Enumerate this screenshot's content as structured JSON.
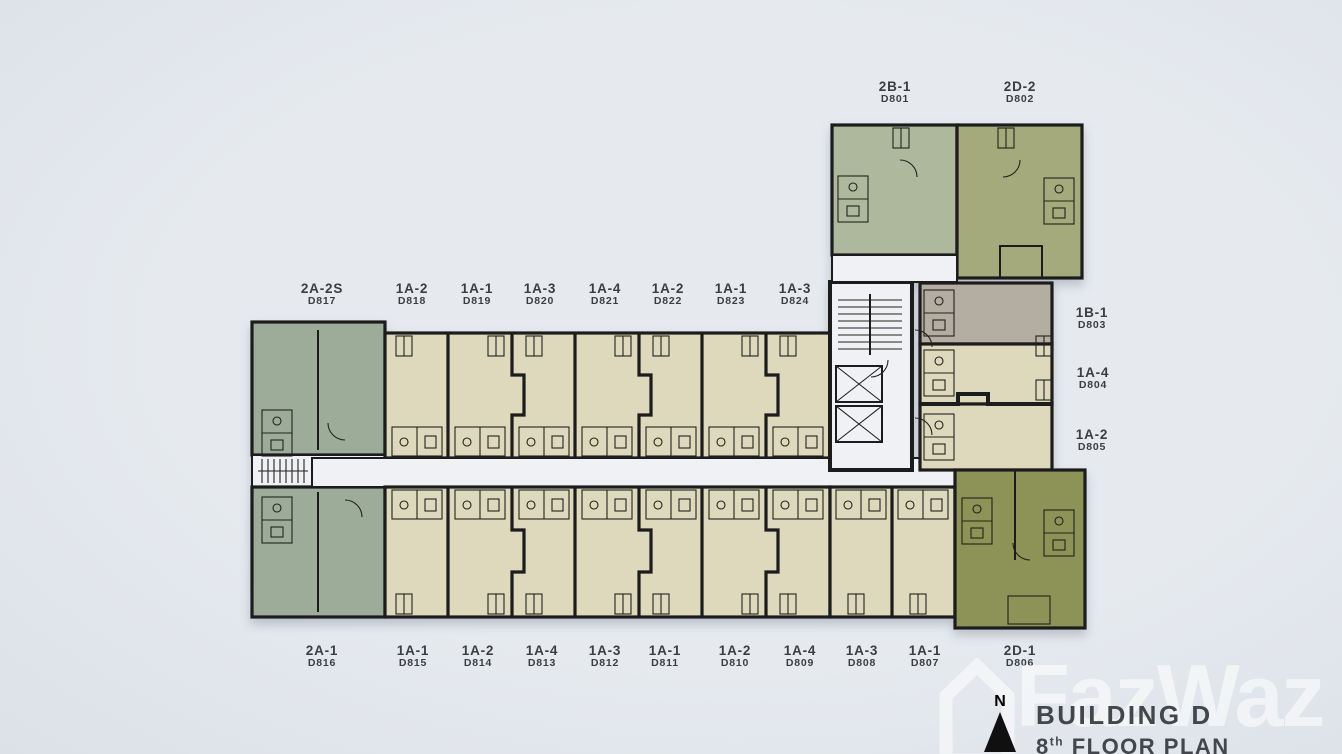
{
  "page": {
    "background": "#e2e6ec"
  },
  "palette": {
    "sage": "#9dac99",
    "sagelight": "#aeb89c",
    "beige": "#ded9bc",
    "olive": "#a5aa7b",
    "olivedark": "#8d9257",
    "taupe": "#b4ada1",
    "corridor": "#eff1f4",
    "wall": "#1c1c1c",
    "label_text": "#3b3e41",
    "title_text": "#43464a",
    "watermark_white": "rgba(255,255,255,0.55)"
  },
  "title_block": {
    "building": "BUILDING D",
    "floor_number": "8",
    "floor_sup": "th",
    "floor_rest": " FLOOR PLAN",
    "compass_label": "N"
  },
  "watermark": {
    "text": "FazWaz"
  },
  "floorplan": {
    "unit_labels": [
      {
        "type": "2A-2S",
        "no": "D817",
        "x": 322,
        "y": 282
      },
      {
        "type": "1A-2",
        "no": "D818",
        "x": 412,
        "y": 282
      },
      {
        "type": "1A-1",
        "no": "D819",
        "x": 477,
        "y": 282
      },
      {
        "type": "1A-3",
        "no": "D820",
        "x": 540,
        "y": 282
      },
      {
        "type": "1A-4",
        "no": "D821",
        "x": 605,
        "y": 282
      },
      {
        "type": "1A-2",
        "no": "D822",
        "x": 668,
        "y": 282
      },
      {
        "type": "1A-1",
        "no": "D823",
        "x": 731,
        "y": 282
      },
      {
        "type": "1A-3",
        "no": "D824",
        "x": 795,
        "y": 282
      },
      {
        "type": "2B-1",
        "no": "D801",
        "x": 895,
        "y": 80
      },
      {
        "type": "2D-2",
        "no": "D802",
        "x": 1020,
        "y": 80
      },
      {
        "type": "1B-1",
        "no": "D803",
        "x": 1092,
        "y": 306
      },
      {
        "type": "1A-4",
        "no": "D804",
        "x": 1093,
        "y": 366
      },
      {
        "type": "1A-2",
        "no": "D805",
        "x": 1092,
        "y": 428
      },
      {
        "type": "2A-1",
        "no": "D816",
        "x": 322,
        "y": 644
      },
      {
        "type": "1A-1",
        "no": "D815",
        "x": 413,
        "y": 644
      },
      {
        "type": "1A-2",
        "no": "D814",
        "x": 478,
        "y": 644
      },
      {
        "type": "1A-4",
        "no": "D813",
        "x": 542,
        "y": 644
      },
      {
        "type": "1A-3",
        "no": "D812",
        "x": 605,
        "y": 644
      },
      {
        "type": "1A-1",
        "no": "D811",
        "x": 665,
        "y": 644
      },
      {
        "type": "1A-2",
        "no": "D810",
        "x": 735,
        "y": 644
      },
      {
        "type": "1A-4",
        "no": "D809",
        "x": 800,
        "y": 644
      },
      {
        "type": "1A-3",
        "no": "D808",
        "x": 862,
        "y": 644
      },
      {
        "type": "1A-1",
        "no": "D807",
        "x": 925,
        "y": 644
      },
      {
        "type": "2D-1",
        "no": "D806",
        "x": 1020,
        "y": 644
      }
    ]
  }
}
